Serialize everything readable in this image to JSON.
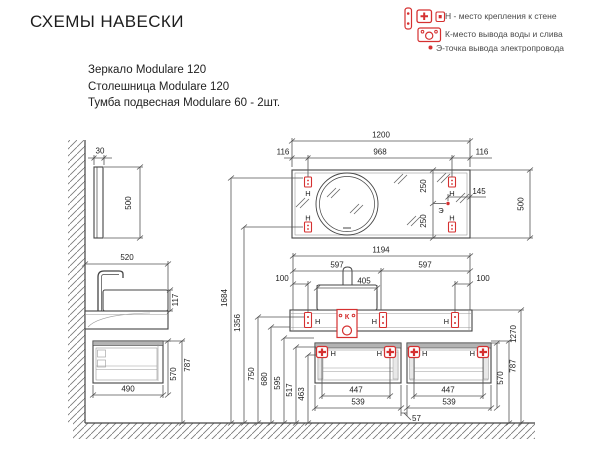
{
  "title": "СХЕМЫ НАВЕСКИ",
  "legend": {
    "wall": "Н - место крепления к стене",
    "water": "К-место вывода воды и слива",
    "electric": "Э-точка вывода электропровода"
  },
  "products": {
    "line1": "Зеркало Modulare 120",
    "line2": "Столешница Modulare 120",
    "line3": "Тумба подвесная Modulare 60 - 2шт."
  },
  "markers": {
    "h": "Н",
    "k": "К",
    "e": "Э"
  },
  "dims": {
    "mirror_width": "1200",
    "mirror_mount_span": "968",
    "mirror_offset_left": "116",
    "mirror_offset_right": "116",
    "mirror_thickness": "30",
    "mirror_height_side": "500",
    "mirror_height_front": "500",
    "e_offset_top": "250",
    "e_offset_bottom": "250",
    "e_offset_right": "145",
    "countertop_depth": "520",
    "basin_height": "117",
    "countertop_width": "1194",
    "countertop_half_left": "597",
    "countertop_half_right": "597",
    "mount_offset_left": "100",
    "mount_offset_right": "100",
    "basin_width": "405",
    "height_mirror_top_mount": "1684",
    "height_mirror_bottom_mount": "1356",
    "height_countertop_mount": "750",
    "height_countertop_bottom": "680",
    "height_cabinet_ext": "595",
    "height_cabinet_mount_upper": "517",
    "height_cabinet_mount_lower": "463",
    "height_countertop_top": "1270",
    "height_cabinet_top": "787",
    "height_cabinet_top_side": "787",
    "cabinet_depth": "490",
    "cabinet_height_side": "570",
    "cabinet_height_right": "570",
    "cabinet_mount_span_left": "447",
    "cabinet_mount_span_right": "447",
    "cabinet_width_left": "539",
    "cabinet_width_right": "539",
    "cabinet_gap": "57"
  },
  "colors": {
    "red": "#d53030",
    "line": "#4a4a4a",
    "text": "#222222"
  }
}
